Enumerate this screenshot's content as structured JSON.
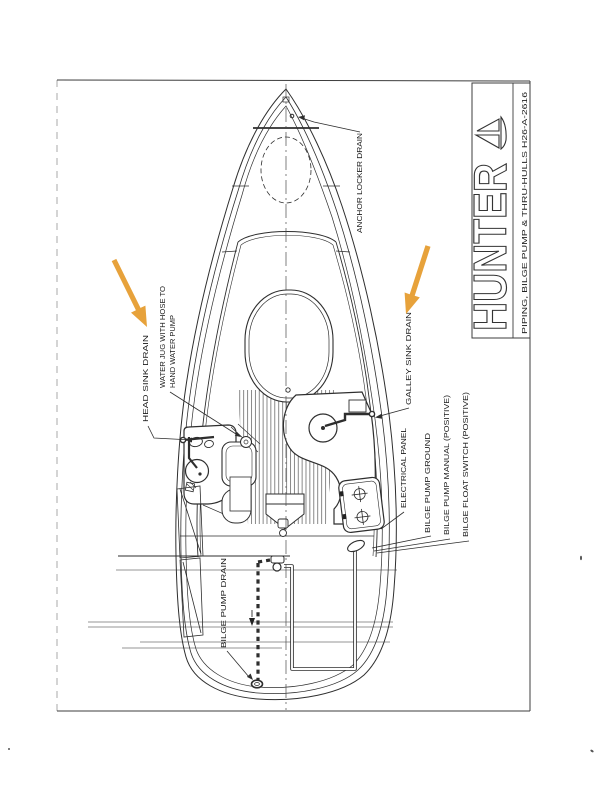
{
  "title_block": {
    "brand": "HUNTER",
    "logo": "sailboat-logo",
    "drawing_title": "PIPING, BILGE PUMP & THRU-HULLS H26-A-2616"
  },
  "labels": {
    "anchor_locker_drain": "ANCHOR LOCKER DRAIN",
    "head_sink_drain": "HEAD SINK DRAIN",
    "water_jug_line1": "WATER JUG WITH HOSE TO",
    "water_jug_line2": "HAND WATER PUMP",
    "galley_sink_drain": "GALLEY SINK DRAIN",
    "electrical_panel": "ELECTRICAL PANEL",
    "bilge_pump_ground": "BILGE PUMP GROUND",
    "bilge_pump_manual": "BILGE PUMP MANUAL (POSITIVE)",
    "bilge_float_switch": "BILGE FLOAT SWITCH (POSITIVE)",
    "bilge_pump_drain": "BILGE PUMP DRAIN"
  },
  "annotations": {
    "arrow_color": "#E7A23B",
    "arrows": [
      {
        "points_to": "HEAD SINK DRAIN"
      },
      {
        "points_to": "GALLEY SINK DRAIN"
      }
    ]
  },
  "colors": {
    "ink": "#2e2e2e",
    "paper": "#ffffff"
  }
}
